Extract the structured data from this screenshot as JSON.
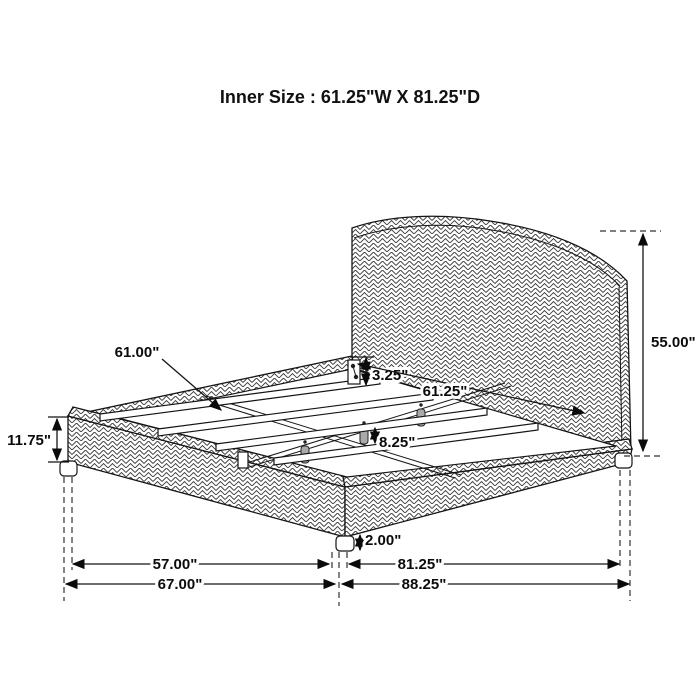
{
  "title": "Inner Size : 61.25\"W X 81.25\"D",
  "dimensions": {
    "slat_length": "61.00\"",
    "side_rail_height": "3.25\"",
    "inner_width": "61.25\"",
    "headboard_height": "55.00\"",
    "footboard_height": "11.75\"",
    "center_support_leg_height": "8.25\"",
    "corner_leg_height": "2.00\"",
    "foot_span_inner": "57.00\"",
    "side_span_inner": "81.25\"",
    "foot_span_overall": "67.00\"",
    "side_span_overall": "88.25\""
  }
}
